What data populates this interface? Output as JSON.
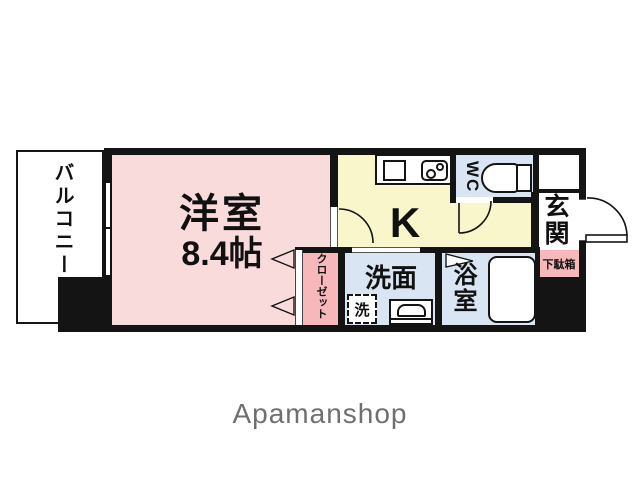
{
  "plan": {
    "logo": "Apamanshop",
    "rooms": {
      "balcony": {
        "label": "バルコニー"
      },
      "western_room": {
        "label": "洋室",
        "size": "8.4帖"
      },
      "kitchen": {
        "label": "K"
      },
      "wc": {
        "label": "WC"
      },
      "entrance": {
        "label": "玄関"
      },
      "shoe_box": {
        "label": "下駄箱"
      },
      "closet": {
        "label": "クローゼット"
      },
      "washroom": {
        "label": "洗面"
      },
      "washing_machine": {
        "label": "洗"
      },
      "bathroom": {
        "label": "浴室"
      }
    },
    "colors": {
      "room_pink": "#fadbdc",
      "storage_pink": "#f6b8ba",
      "kitchen_yellow": "#faf6cb",
      "wet_area_blue": "#d9e5f2",
      "wall_black": "#141414",
      "logo_gray": "#6f6f6f"
    }
  }
}
